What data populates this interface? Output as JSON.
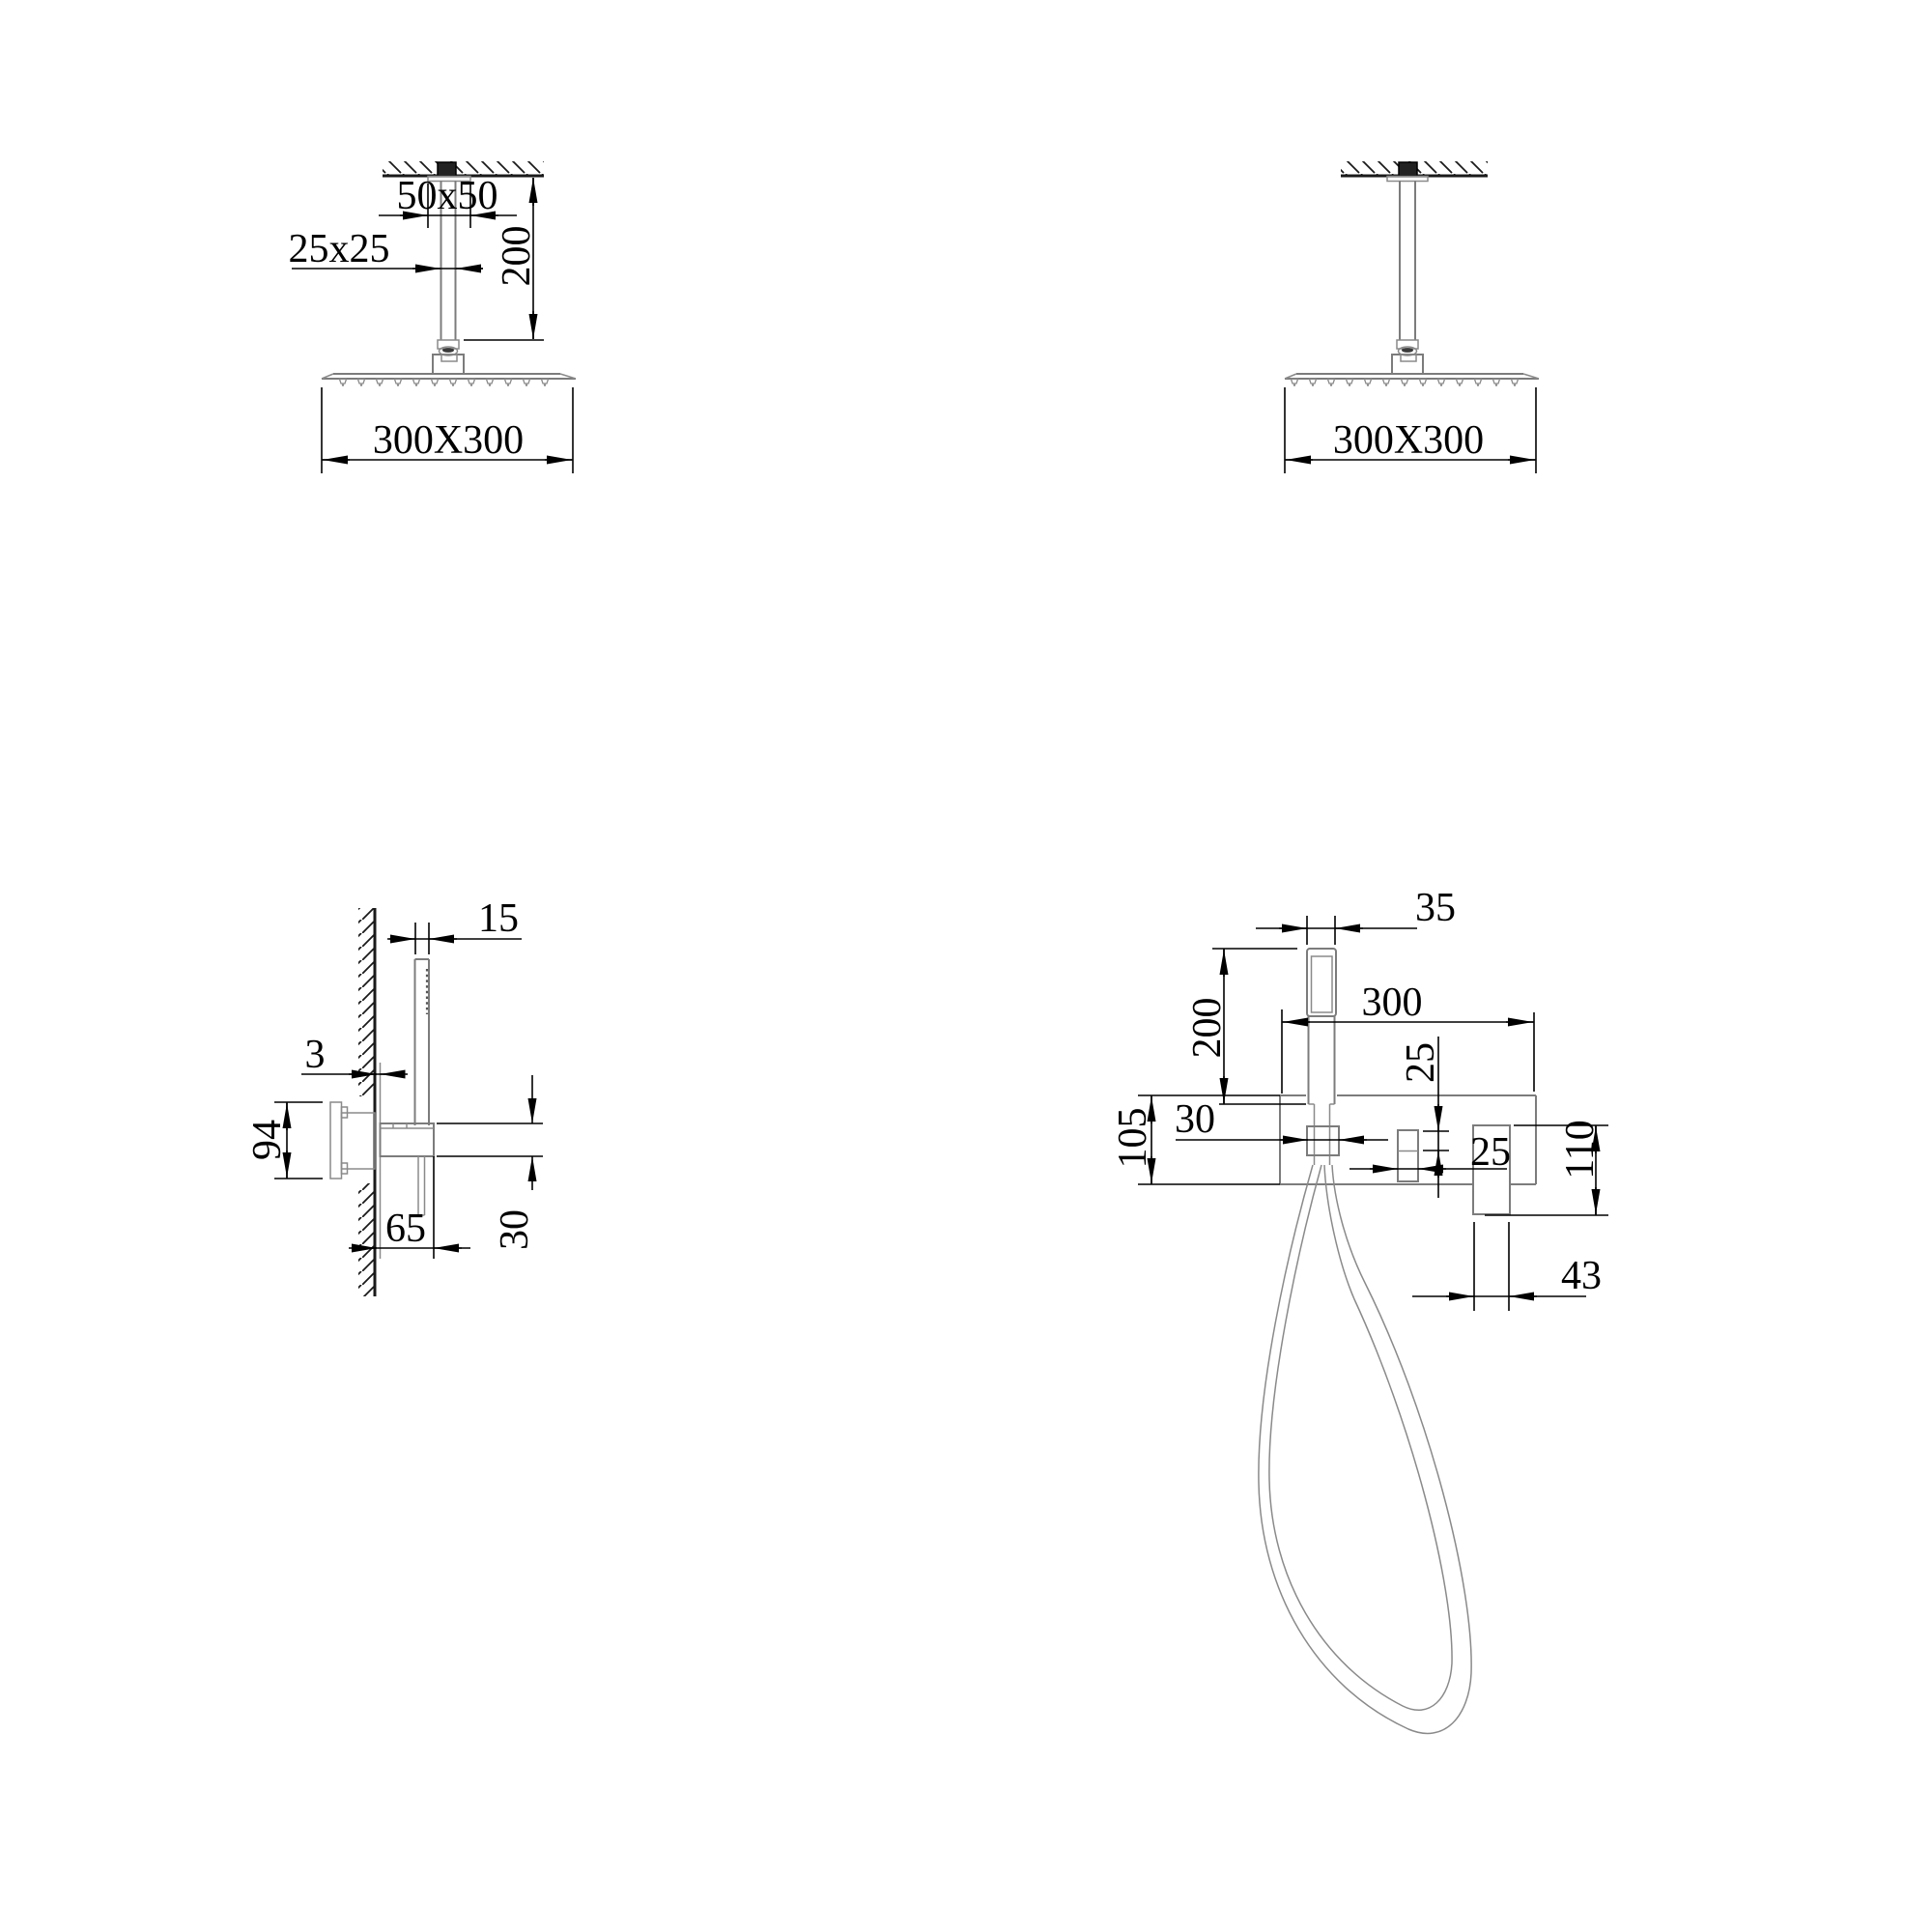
{
  "document": {
    "type": "technical-dimension-drawing",
    "subject": "shower set installation dimensions",
    "background_color": "#ffffff",
    "line_color": "#000000",
    "fixture_line_color": "#7c7c7c"
  },
  "views": {
    "ceiling_left": {
      "name": "ceiling shower head with dimensions",
      "dims": {
        "flange": "50x50",
        "arm": "25x25",
        "drop": "200",
        "head": "300X300"
      }
    },
    "ceiling_right": {
      "name": "ceiling shower head",
      "dims": {
        "head": "300X300"
      }
    },
    "wall_side": {
      "name": "hand shower and mixer side view",
      "dims": {
        "handset_width": "15",
        "plate_gap": "3",
        "valve_height": "94",
        "projection": "65",
        "spout_height": "30"
      }
    },
    "wall_front": {
      "name": "hand shower and mixer front view",
      "dims": {
        "handset_width": "35",
        "handset_height": "200",
        "plate_width": "300",
        "outlet_offset": "25",
        "plate_height": "105",
        "holder_width": "30",
        "knob_width": "25",
        "handle_height": "110",
        "handle_width": "43"
      }
    }
  }
}
